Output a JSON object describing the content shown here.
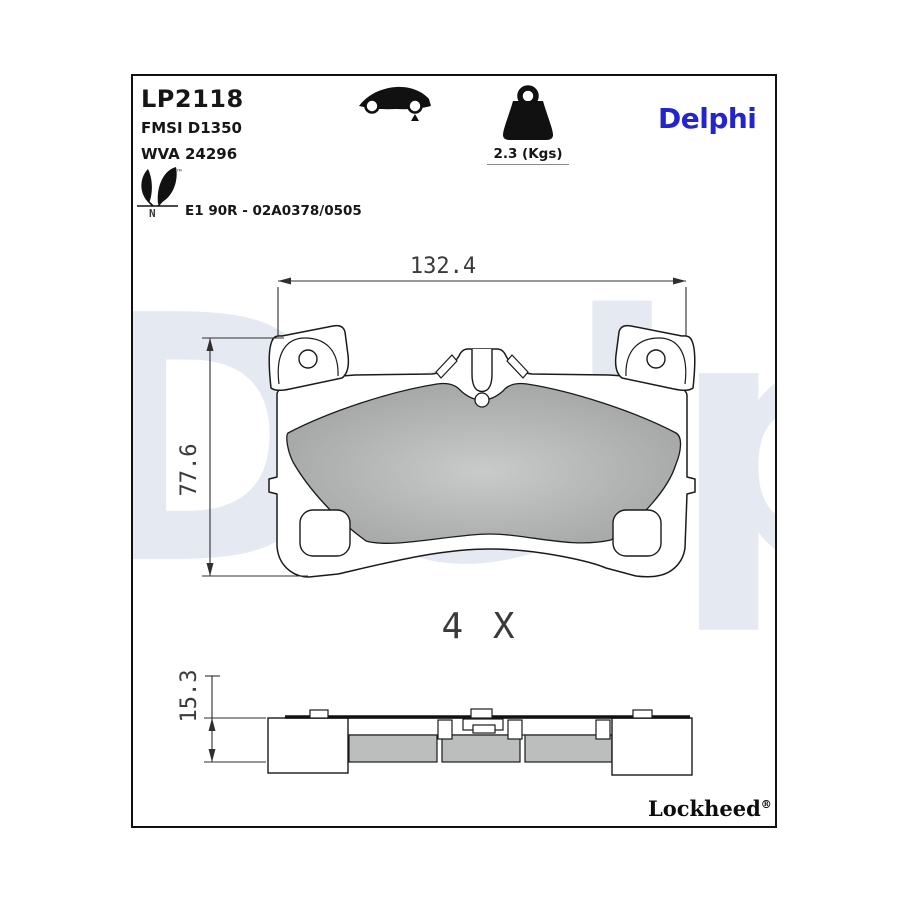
{
  "header": {
    "part_number": "LP2118",
    "fmsi": "FMSI D1350",
    "wva": "WVA 24296",
    "approval": "E1 90R - 02A0378/0505",
    "eco": {
      "icon": "leaf-eco-icon",
      "trademark": "™",
      "letter": "N"
    },
    "vehicle_position": {
      "icon": "car-rear-axle-icon"
    },
    "weight": {
      "icon": "weight-icon",
      "label": "2.3 (Kgs)"
    }
  },
  "brand": {
    "logo_text": "Delphi",
    "logo_color": "#2424cd",
    "watermark_text": "Delphi",
    "watermark_color": "#e4e9f2",
    "sub_brand_text": "Lockheed",
    "registered_mark": "®"
  },
  "drawing": {
    "quantity_label": "4 X",
    "dimensions": {
      "width_mm": "132.4",
      "height_mm": "77.6",
      "thickness_mm": "15.3"
    },
    "friction_color": "#b2b4b3",
    "line_color": "#1a1a1a"
  }
}
